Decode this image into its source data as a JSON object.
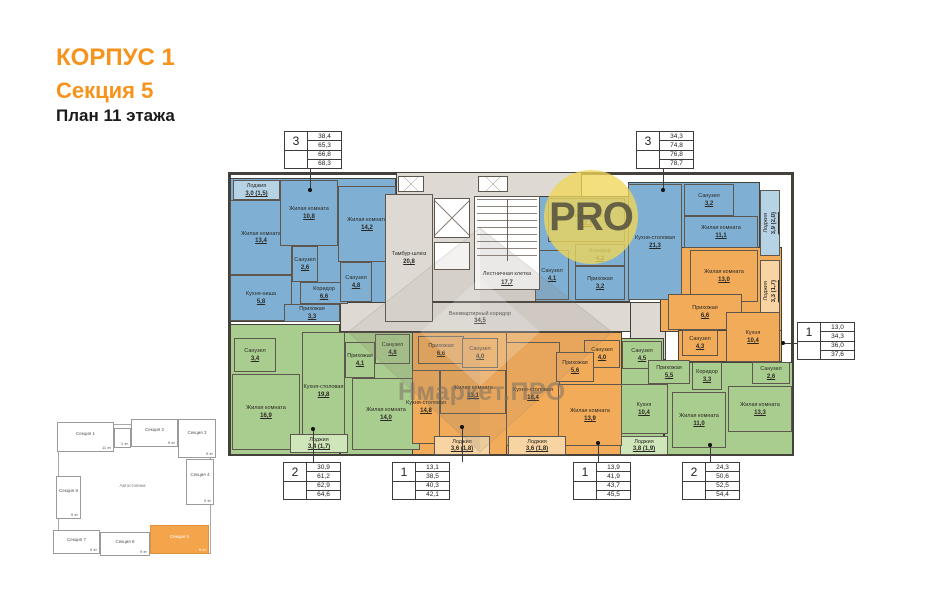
{
  "header": {
    "building": "КОРПУС 1",
    "section": "Секция 5",
    "plan": "План 11 этажа"
  },
  "watermark": {
    "logo": "PRO",
    "brand": "Нмаркет.ПРО"
  },
  "colors": {
    "title_orange": "#F6931D",
    "blue": "#7FB0D3",
    "blue_light": "#B6D3E6",
    "green": "#A9CD8E",
    "green_light": "#CFE5BA",
    "orange": "#F2AB59",
    "orange_light": "#F8D4A2",
    "gray": "#DEDAD3",
    "white": "#FFFFFF",
    "wall": "#44403A",
    "minimap_orange": "#F4A54C"
  },
  "spec_tables": [
    {
      "number": "3",
      "values": [
        "38,4",
        "65,3",
        "66,8",
        "68,3"
      ],
      "x": 284,
      "y": 131,
      "leader": {
        "line": {
          "x": 310,
          "y": 169,
          "w": 1,
          "h": 22
        },
        "dot": {
          "x": 310,
          "y": 190
        }
      }
    },
    {
      "number": "3",
      "values": [
        "34,3",
        "74,8",
        "76,8",
        "78,7"
      ],
      "x": 636,
      "y": 131,
      "leader": {
        "line": {
          "x": 663,
          "y": 169,
          "w": 1,
          "h": 22
        },
        "dot": {
          "x": 663,
          "y": 190
        }
      }
    },
    {
      "number": "1",
      "values": [
        "13,0",
        "34,3",
        "36,0",
        "37,6"
      ],
      "x": 797,
      "y": 322,
      "leader": {
        "line": {
          "x": 783,
          "y": 343,
          "w": 14,
          "h": 1
        },
        "dot": {
          "x": 783,
          "y": 343
        }
      }
    },
    {
      "number": "2",
      "values": [
        "30,9",
        "61,2",
        "62,9",
        "64,6"
      ],
      "x": 283,
      "y": 462,
      "leader": {
        "line": {
          "x": 313,
          "y": 430,
          "w": 1,
          "h": 32
        },
        "dot": {
          "x": 313,
          "y": 429
        }
      }
    },
    {
      "number": "1",
      "values": [
        "13,1",
        "38,5",
        "40,3",
        "42,1"
      ],
      "x": 392,
      "y": 462,
      "leader": {
        "line": {
          "x": 462,
          "y": 428,
          "w": 1,
          "h": 34
        },
        "dot": {
          "x": 462,
          "y": 427
        }
      }
    },
    {
      "number": "1",
      "values": [
        "13,9",
        "41,9",
        "43,7",
        "45,5"
      ],
      "x": 573,
      "y": 462,
      "leader": {
        "line": {
          "x": 598,
          "y": 444,
          "w": 1,
          "h": 18
        },
        "dot": {
          "x": 598,
          "y": 443
        }
      }
    },
    {
      "number": "2",
      "values": [
        "24,3",
        "50,6",
        "52,5",
        "54,4"
      ],
      "x": 682,
      "y": 462,
      "leader": {
        "line": {
          "x": 710,
          "y": 446,
          "w": 1,
          "h": 16
        },
        "dot": {
          "x": 710,
          "y": 445
        }
      }
    }
  ],
  "plan": {
    "frame": {
      "x": 228,
      "y": 172,
      "w": 566,
      "h": 284
    },
    "bases": [
      {
        "x": 230,
        "y": 178,
        "w": 166,
        "h": 144,
        "fill": "blue"
      },
      {
        "x": 396,
        "y": 172,
        "w": 186,
        "h": 130,
        "fill": "gray"
      },
      {
        "x": 340,
        "y": 302,
        "w": 292,
        "h": 30,
        "fill": "gray"
      },
      {
        "x": 630,
        "y": 302,
        "w": 36,
        "h": 58,
        "fill": "gray"
      },
      {
        "x": 535,
        "y": 196,
        "w": 95,
        "h": 106,
        "fill": "blue"
      },
      {
        "x": 628,
        "y": 182,
        "w": 132,
        "h": 66,
        "fill": "blue"
      },
      {
        "x": 660,
        "y": 247,
        "w": 122,
        "h": 85,
        "fill": "orange"
      },
      {
        "x": 678,
        "y": 330,
        "w": 104,
        "h": 32,
        "fill": "orange"
      },
      {
        "x": 618,
        "y": 338,
        "w": 46,
        "h": 117,
        "fill": "green"
      },
      {
        "x": 664,
        "y": 362,
        "w": 129,
        "h": 93,
        "fill": "green"
      },
      {
        "x": 230,
        "y": 324,
        "w": 110,
        "h": 131,
        "fill": "green"
      },
      {
        "x": 340,
        "y": 332,
        "w": 80,
        "h": 123,
        "fill": "green"
      },
      {
        "x": 412,
        "y": 332,
        "w": 96,
        "h": 123,
        "fill": "orange"
      },
      {
        "x": 506,
        "y": 332,
        "w": 116,
        "h": 123,
        "fill": "orange"
      }
    ],
    "rooms": [
      {
        "kind": "loggia",
        "name": "Лоджия",
        "value": "3,0 (1,5)",
        "x": 233,
        "y": 180,
        "w": 47,
        "h": 20,
        "fill": "blue_light"
      },
      {
        "kind": "living",
        "name": "Жилая комната",
        "value": "13,4",
        "x": 230,
        "y": 200,
        "w": 62,
        "h": 75,
        "fill": "blue"
      },
      {
        "kind": "kitchen",
        "name": "Кухня-ниша",
        "value": "5,8",
        "x": 230,
        "y": 275,
        "w": 62,
        "h": 46,
        "fill": "blue"
      },
      {
        "kind": "living",
        "name": "Жилая комната",
        "value": "10,8",
        "x": 280,
        "y": 180,
        "w": 58,
        "h": 66,
        "fill": "blue"
      },
      {
        "kind": "living",
        "name": "Жилая комната",
        "value": "14,2",
        "x": 338,
        "y": 186,
        "w": 58,
        "h": 76,
        "fill": "blue"
      },
      {
        "kind": "bathroom",
        "name": "Санузел",
        "value": "2,6",
        "x": 292,
        "y": 246,
        "w": 26,
        "h": 36,
        "fill": "blue"
      },
      {
        "kind": "corridor",
        "name": "Коридор",
        "value": "6,6",
        "x": 300,
        "y": 282,
        "w": 48,
        "h": 22,
        "fill": "blue"
      },
      {
        "kind": "bathroom",
        "name": "Санузел",
        "value": "4,8",
        "x": 340,
        "y": 262,
        "w": 32,
        "h": 40,
        "fill": "blue"
      },
      {
        "kind": "hall",
        "name": "Прихожая",
        "value": "3,3",
        "x": 284,
        "y": 304,
        "w": 56,
        "h": 18,
        "fill": "blue"
      },
      {
        "kind": "tambour",
        "name": "Тамбур-шлюз",
        "value": "20,8",
        "x": 385,
        "y": 194,
        "w": 48,
        "h": 128,
        "fill": "gray"
      },
      {
        "kind": "common-corridor",
        "name": "Внеквартирный коридор",
        "value": "34,5",
        "x": 420,
        "y": 304,
        "w": 120,
        "h": 27,
        "fill": "none"
      },
      {
        "kind": "living",
        "name": "Жилая комната",
        "value": "12,1",
        "x": 548,
        "y": 198,
        "w": 77,
        "h": 44,
        "fill": "blue"
      },
      {
        "kind": "corridor",
        "name": "Коридор",
        "value": "4,2",
        "x": 575,
        "y": 244,
        "w": 50,
        "h": 22,
        "fill": "blue"
      },
      {
        "kind": "hall",
        "name": "Прихожая",
        "value": "3,2",
        "x": 575,
        "y": 266,
        "w": 50,
        "h": 34,
        "fill": "blue"
      },
      {
        "kind": "bathroom",
        "name": "Санузел",
        "value": "4,1",
        "x": 535,
        "y": 250,
        "w": 34,
        "h": 50,
        "fill": "blue"
      },
      {
        "kind": "kitchen",
        "name": "Кухня-столовая",
        "value": "21,3",
        "x": 628,
        "y": 184,
        "w": 54,
        "h": 116,
        "fill": "blue"
      },
      {
        "kind": "bathroom",
        "name": "Санузел",
        "value": "3,2",
        "x": 684,
        "y": 184,
        "w": 50,
        "h": 32,
        "fill": "blue"
      },
      {
        "kind": "living",
        "name": "Жилая комната",
        "value": "11,1",
        "x": 684,
        "y": 216,
        "w": 74,
        "h": 32,
        "fill": "blue"
      },
      {
        "kind": "loggia",
        "name": "Лоджия",
        "value": "3,9 (2,0)",
        "x": 760,
        "y": 190,
        "w": 20,
        "h": 66,
        "fill": "blue_light",
        "rot": true
      },
      {
        "kind": "living",
        "name": "Жилая комната",
        "value": "13,0",
        "x": 690,
        "y": 250,
        "w": 68,
        "h": 52,
        "fill": "orange"
      },
      {
        "kind": "loggia",
        "name": "Лоджия",
        "value": "3,3 (1,7)",
        "x": 760,
        "y": 260,
        "w": 20,
        "h": 62,
        "fill": "orange_light",
        "rot": true
      },
      {
        "kind": "hall",
        "name": "Прихожая",
        "value": "6,6",
        "x": 668,
        "y": 294,
        "w": 74,
        "h": 36,
        "fill": "orange"
      },
      {
        "kind": "bathroom",
        "name": "Санузел",
        "value": "4,3",
        "x": 682,
        "y": 330,
        "w": 36,
        "h": 26,
        "fill": "orange"
      },
      {
        "kind": "kitchen",
        "name": "Кухня",
        "value": "10,4",
        "x": 726,
        "y": 312,
        "w": 54,
        "h": 50,
        "fill": "orange"
      },
      {
        "kind": "bathroom",
        "name": "Санузел",
        "value": "4,5",
        "x": 622,
        "y": 341,
        "w": 40,
        "h": 28,
        "fill": "green"
      },
      {
        "kind": "hall",
        "name": "Прихожая",
        "value": "5,5",
        "x": 648,
        "y": 360,
        "w": 42,
        "h": 24,
        "fill": "green"
      },
      {
        "kind": "corridor",
        "name": "Коридор",
        "value": "3,3",
        "x": 692,
        "y": 362,
        "w": 30,
        "h": 28,
        "fill": "green"
      },
      {
        "kind": "bathroom",
        "name": "Санузел",
        "value": "2,6",
        "x": 752,
        "y": 362,
        "w": 38,
        "h": 22,
        "fill": "green"
      },
      {
        "kind": "living",
        "name": "Жилая комната",
        "value": "13,3",
        "x": 728,
        "y": 386,
        "w": 64,
        "h": 46,
        "fill": "green"
      },
      {
        "kind": "living",
        "name": "Жилая комната",
        "value": "11,0",
        "x": 672,
        "y": 392,
        "w": 54,
        "h": 56,
        "fill": "green"
      },
      {
        "kind": "kitchen",
        "name": "Кухня",
        "value": "10,4",
        "x": 620,
        "y": 384,
        "w": 48,
        "h": 50,
        "fill": "green"
      },
      {
        "kind": "loggia",
        "name": "Лоджия",
        "value": "3,8 (1,9)",
        "x": 620,
        "y": 436,
        "w": 48,
        "h": 19,
        "fill": "green_light"
      },
      {
        "kind": "bathroom",
        "name": "Санузел",
        "value": "3,4",
        "x": 234,
        "y": 338,
        "w": 42,
        "h": 34,
        "fill": "green"
      },
      {
        "kind": "living",
        "name": "Жилая комната",
        "value": "16,9",
        "x": 232,
        "y": 374,
        "w": 68,
        "h": 76,
        "fill": "green"
      },
      {
        "kind": "kitchen",
        "name": "Кухня-столовая",
        "value": "19,8",
        "x": 302,
        "y": 332,
        "w": 43,
        "h": 118,
        "fill": "green"
      },
      {
        "kind": "hall",
        "name": "Прихожая",
        "value": "4,1",
        "x": 345,
        "y": 342,
        "w": 30,
        "h": 36,
        "fill": "green"
      },
      {
        "kind": "bathroom",
        "name": "Санузел",
        "value": "4,8",
        "x": 375,
        "y": 334,
        "w": 35,
        "h": 30,
        "fill": "green"
      },
      {
        "kind": "living",
        "name": "Жилая комната",
        "value": "14,0",
        "x": 352,
        "y": 378,
        "w": 68,
        "h": 72,
        "fill": "green"
      },
      {
        "kind": "loggia",
        "name": "Лоджия",
        "value": "3,4 (1,7)",
        "x": 290,
        "y": 434,
        "w": 58,
        "h": 19,
        "fill": "green_light"
      },
      {
        "kind": "hall",
        "name": "Прихожая",
        "value": "6,6",
        "x": 418,
        "y": 336,
        "w": 46,
        "h": 28,
        "fill": "orange"
      },
      {
        "kind": "bathroom",
        "name": "Санузел",
        "value": "4,0",
        "x": 462,
        "y": 338,
        "w": 36,
        "h": 30,
        "fill": "orange"
      },
      {
        "kind": "living",
        "name": "Жилая комната",
        "value": "13,1",
        "x": 440,
        "y": 370,
        "w": 66,
        "h": 44,
        "fill": "orange"
      },
      {
        "kind": "kitchen",
        "name": "Кухня-столовая",
        "value": "14,8",
        "x": 412,
        "y": 370,
        "w": 28,
        "h": 74,
        "fill": "orange"
      },
      {
        "kind": "loggia",
        "name": "Лоджия",
        "value": "3,6 (1,8)",
        "x": 434,
        "y": 436,
        "w": 56,
        "h": 19,
        "fill": "orange_light"
      },
      {
        "kind": "kitchen",
        "name": "Кухня-столовая",
        "value": "18,4",
        "x": 506,
        "y": 342,
        "w": 54,
        "h": 104,
        "fill": "orange"
      },
      {
        "kind": "bathroom",
        "name": "Санузел",
        "value": "4,0",
        "x": 584,
        "y": 340,
        "w": 36,
        "h": 28,
        "fill": "orange"
      },
      {
        "kind": "hall",
        "name": "Прихожая",
        "value": "5,6",
        "x": 556,
        "y": 352,
        "w": 38,
        "h": 30,
        "fill": "orange"
      },
      {
        "kind": "living",
        "name": "Жилая комната",
        "value": "13,9",
        "x": 558,
        "y": 384,
        "w": 64,
        "h": 62,
        "fill": "orange"
      },
      {
        "kind": "loggia",
        "name": "Лоджия",
        "value": "3,6 (1,8)",
        "x": 508,
        "y": 436,
        "w": 58,
        "h": 19,
        "fill": "orange_light"
      }
    ],
    "stairwell": {
      "name": "Лестничная клетка",
      "value": "17,7"
    },
    "elevators": [
      {
        "x": 434,
        "y": 198,
        "w": 36,
        "h": 40,
        "cross": true
      },
      {
        "x": 434,
        "y": 242,
        "w": 36,
        "h": 28,
        "cross": false
      },
      {
        "x": 398,
        "y": 176,
        "w": 26,
        "h": 16,
        "cross": true
      },
      {
        "x": 478,
        "y": 176,
        "w": 30,
        "h": 16,
        "cross": true
      }
    ]
  },
  "minimap": {
    "center_label": "Автостоянка",
    "outline": {
      "x": 58,
      "y": 424,
      "w": 153,
      "h": 130
    },
    "sections": [
      {
        "label": "Секция 1",
        "floors": "11 эт",
        "x": 57,
        "y": 422,
        "w": 57,
        "h": 30
      },
      {
        "label": "",
        "floors": "1 эт",
        "x": 114,
        "y": 428,
        "w": 17,
        "h": 20
      },
      {
        "label": "Секция 2",
        "floors": "9 эт",
        "x": 131,
        "y": 419,
        "w": 47,
        "h": 28
      },
      {
        "label": "Секция 3",
        "floors": "9 эт",
        "x": 178,
        "y": 419,
        "w": 38,
        "h": 39
      },
      {
        "label": "Секция 4",
        "floors": "9 эт",
        "x": 186,
        "y": 459,
        "w": 28,
        "h": 46
      },
      {
        "label": "Секция 8",
        "floors": "9 эт",
        "x": 56,
        "y": 476,
        "w": 25,
        "h": 43
      },
      {
        "label": "Секция 7",
        "floors": "9 эт",
        "x": 53,
        "y": 530,
        "w": 47,
        "h": 24
      },
      {
        "label": "Секция 6",
        "floors": "9 эт",
        "x": 100,
        "y": 532,
        "w": 50,
        "h": 24
      },
      {
        "label": "Секция 5",
        "floors": "9 эт",
        "x": 150,
        "y": 525,
        "w": 59,
        "h": 29,
        "highlighted": true
      }
    ]
  }
}
